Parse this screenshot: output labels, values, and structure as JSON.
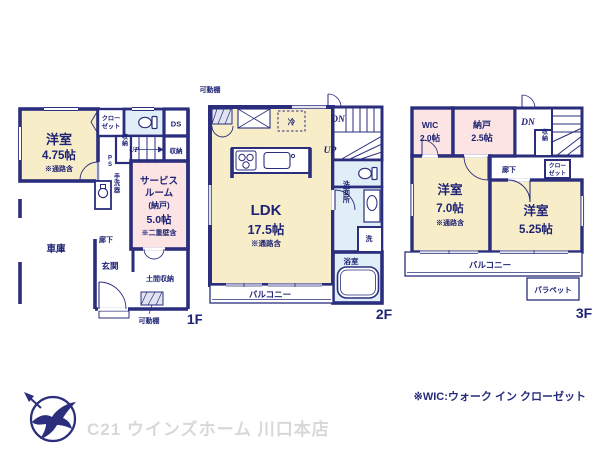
{
  "colors": {
    "wall_navy": "#2a2e7d",
    "room_yellow": "#f8edc9",
    "room_pink": "#fbe4e3",
    "room_blue": "#e0eff7",
    "label_navy": "#1e2374",
    "footer_gray": "#d8d8d8"
  },
  "f1": {
    "floor_label": "1F",
    "yoshitsu_name": "洋室",
    "yoshitsu_size": "4.75帖",
    "yoshitsu_note": "※通路含",
    "closet_l1": "クロー",
    "closet_l2": "ゼット",
    "ds": "DS",
    "shuno_mid": "収納",
    "up": "UP",
    "shuno_right": "収納",
    "ps": "PS",
    "tearaiki": "手洗器",
    "service_l1": "サービス",
    "service_l2": "ルーム",
    "service_l3": "(納戸)",
    "service_size": "5.0帖",
    "service_note": "※二重壁含",
    "garage": "車庫",
    "roka": "廊下",
    "genkan": "玄関",
    "doma_shuno": "土間収納",
    "kadoudana": "可動棚"
  },
  "f2": {
    "floor_label": "2F",
    "kadoudana": "可動棚",
    "rei": "冷",
    "dn": "DN",
    "up": "UP",
    "ldk_name": "LDK",
    "ldk_size": "17.5帖",
    "ldk_note": "※通路含",
    "senmenjo": "洗面所",
    "sen": "洗",
    "yokushitsu": "浴室",
    "balcony": "バルコニー"
  },
  "f3": {
    "floor_label": "3F",
    "wic_name": "WIC",
    "wic_size": "2.0帖",
    "nando_name": "納戸",
    "nando_size": "2.5帖",
    "dn": "DN",
    "shuno": "収納",
    "roka": "廊下",
    "closet_l1": "クロー",
    "closet_l2": "ゼット",
    "yo7_name": "洋室",
    "yo7_size": "7.0帖",
    "yo7_note": "※通路含",
    "yo525_name": "洋室",
    "yo525_size": "5.25帖",
    "balcony": "バルコニー",
    "parapet": "パラペット"
  },
  "footer": {
    "company": "C21 ウインズホーム 川口本店",
    "wic_note": "※WIC:ウォーク イン クローゼット"
  }
}
